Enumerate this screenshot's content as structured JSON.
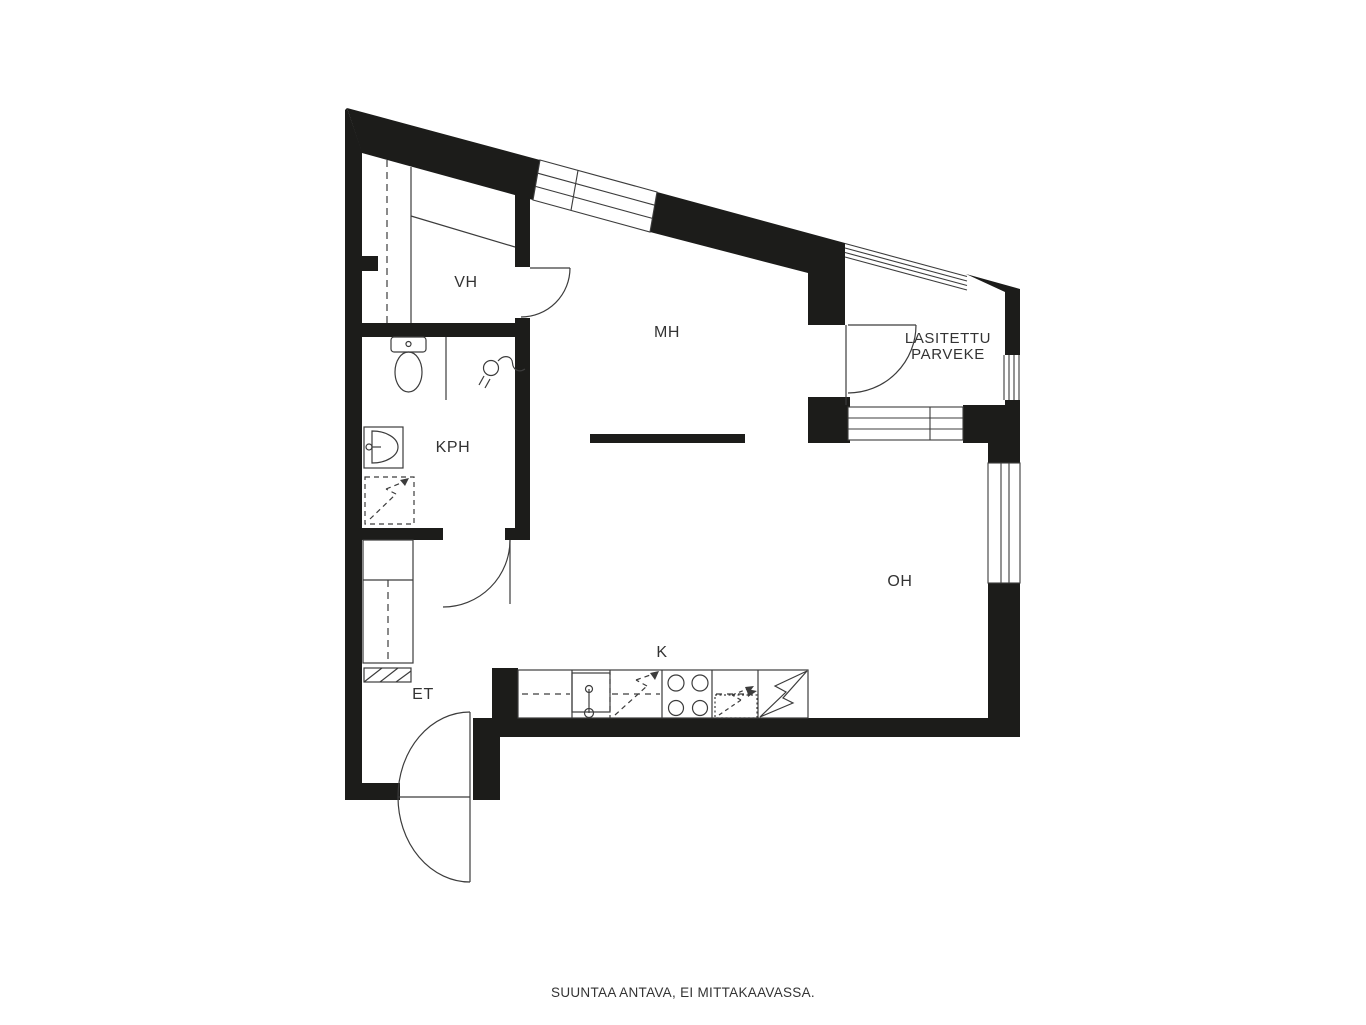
{
  "caption": "SUUNTAA ANTAVA, EI MITTAKAAVASSA.",
  "rooms": {
    "vh": "VH",
    "mh": "MH",
    "kph": "KPH",
    "et": "ET",
    "kitchen": "K",
    "oh": "OH",
    "balcony_line1": "LASITETTU",
    "balcony_line2": "PARVEKE"
  },
  "icons": {
    "toilet": "toilet-icon",
    "shower": "shower-icon",
    "washbasin": "washbasin-icon",
    "washing_machine_reservation": "dashed-lightning-symbol",
    "kitchen_sink": "kitchen-sink-icon",
    "dishwasher_reservation": "dashed-lightning-symbol",
    "stove": "stove-burners-icon",
    "fridge": "solid-lightning-symbol"
  },
  "colors": {
    "background": "#ffffff",
    "wall": "#1c1c1a",
    "line": "#3c3c3c",
    "text": "#333333"
  }
}
